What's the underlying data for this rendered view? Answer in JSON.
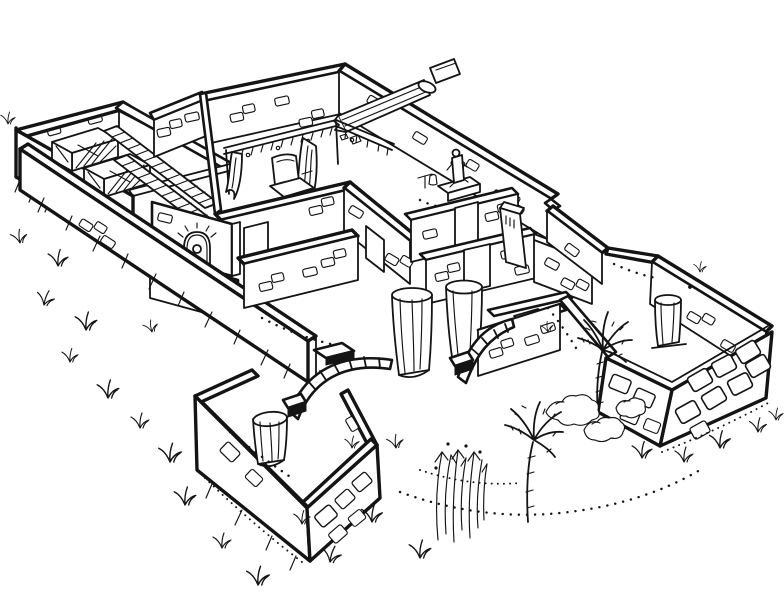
{
  "figure": {
    "subject": "Isometric cutaway line drawing of an ancient walled house compound",
    "description": "Black-ink archaeological illustration seen from above: storerooms with bins and slatted shelving, a bed chamber with curtained canopy and stepped dais, a shrine room with a statue on a pedestal, a chapel niche with a seated figure, a columned hall with two papyrus columns and arched stairways, a forecourt with a broken column stump, a walled garden court with palm trees and shrubs, stone-block perimeter walls, a fallen broken column on the rear wall, grass tufts and stippled paths outside.",
    "ink_color": "#141414",
    "paper_color": "#ffffff"
  },
  "scene": {
    "areas": [
      {
        "name": "storeroom-block",
        "features": [
          "hatched storage bins",
          "slatted shelf screens"
        ]
      },
      {
        "name": "bed-chamber",
        "features": [
          "canopy valance",
          "hanging curtains",
          "throne couch",
          "stepped dais"
        ]
      },
      {
        "name": "shrine-room",
        "features": [
          "seated statue",
          "pedestal",
          "offering stand"
        ]
      },
      {
        "name": "niche-chapel",
        "features": [
          "arched niche",
          "seated figure"
        ]
      },
      {
        "name": "columned-hall",
        "features": [
          "two columns",
          "arched stairway",
          "landing slab"
        ]
      },
      {
        "name": "forecourt",
        "features": [
          "broken column stump",
          "stone-block walls"
        ]
      },
      {
        "name": "garden-court",
        "features": [
          "palm trees",
          "shrubs",
          "standing column"
        ]
      },
      {
        "name": "perimeter",
        "features": [
          "fallen broken column",
          "stone-block masonry",
          "grass tufts",
          "stippled path"
        ]
      }
    ]
  }
}
